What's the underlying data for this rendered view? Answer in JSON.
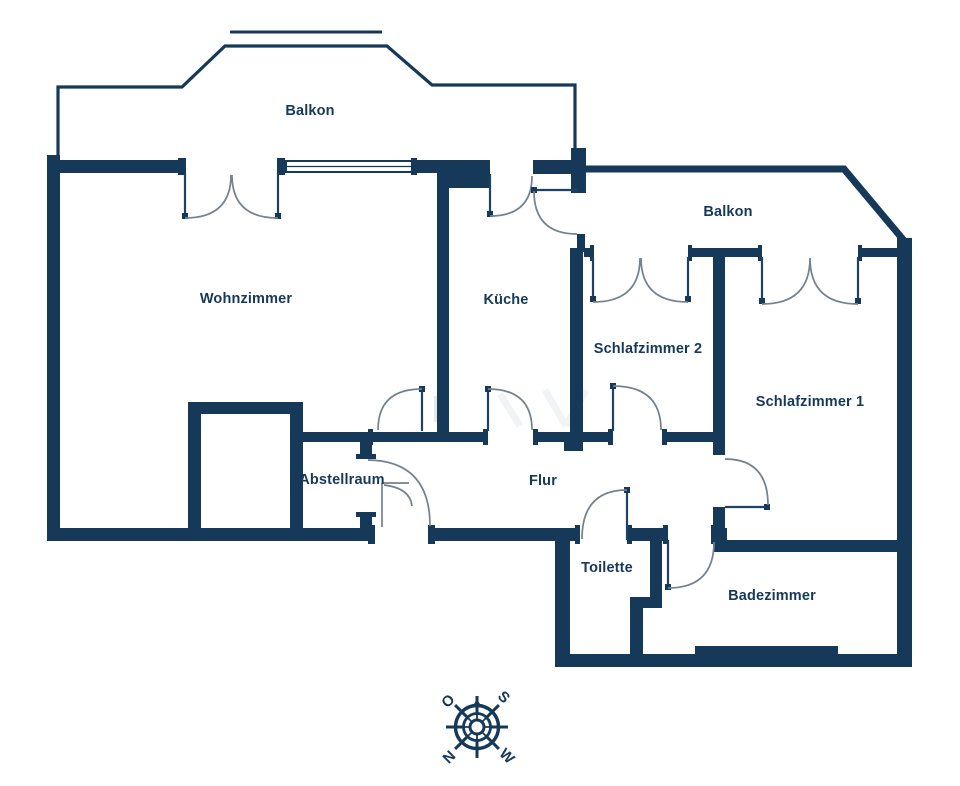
{
  "colors": {
    "background": "#ffffff",
    "wall": "#16395a",
    "door_leaf": "#1f4163",
    "door_arc": "#74818e",
    "room_label": "#16395a",
    "watermark": "#e6eaee"
  },
  "rooms": [
    {
      "id": "balkon-left",
      "label": "Balkon"
    },
    {
      "id": "wohnzimmer",
      "label": "Wohnzimmer"
    },
    {
      "id": "kueche",
      "label": "Küche"
    },
    {
      "id": "balkon-right",
      "label": "Balkon"
    },
    {
      "id": "schlafzimmer-2",
      "label": "Schlafzimmer 2"
    },
    {
      "id": "schlafzimmer-1",
      "label": "Schlafzimmer 1"
    },
    {
      "id": "abstellraum",
      "label": "Abstellraum"
    },
    {
      "id": "flur",
      "label": "Flur"
    },
    {
      "id": "toilette",
      "label": "Toilette"
    },
    {
      "id": "badezimmer",
      "label": "Badezimmer"
    }
  ],
  "compass": {
    "top_left": "O",
    "top_right": "S",
    "bottom_left": "N",
    "bottom_right": "W"
  }
}
